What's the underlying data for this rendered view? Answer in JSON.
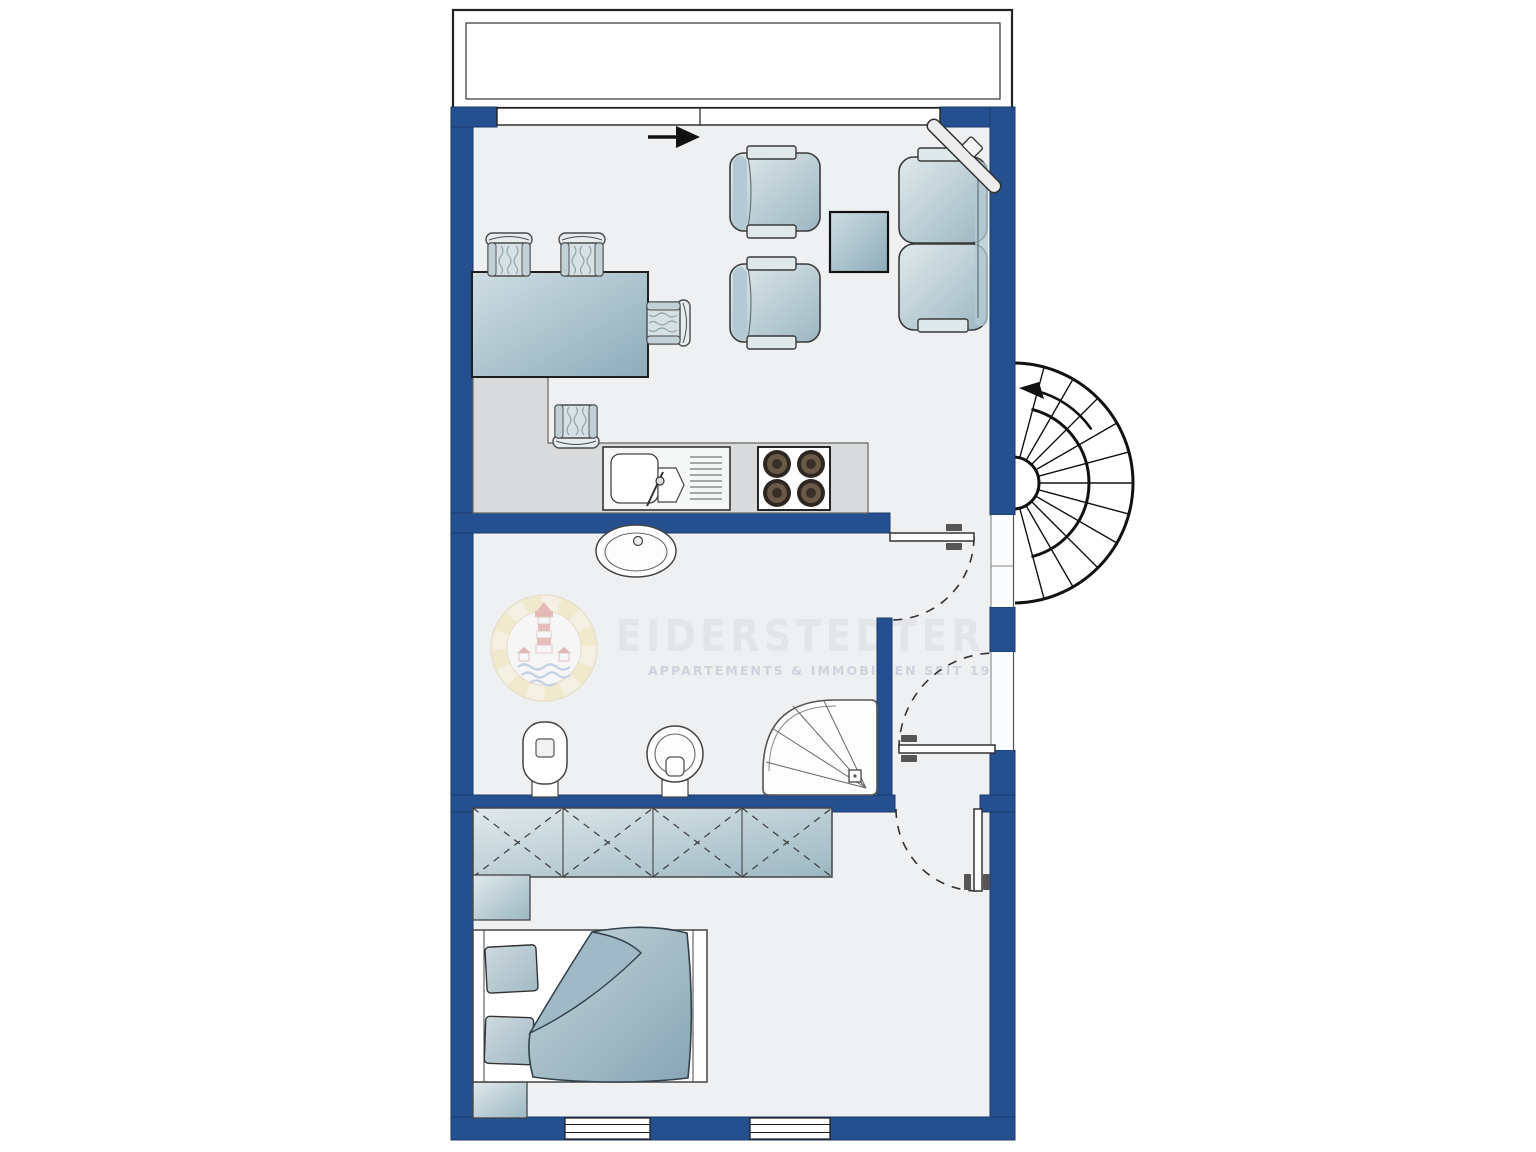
{
  "document": {
    "type": "apartment-floor-plan",
    "description": "Top-down architectural floor plan of a one-bedroom apartment with balcony and external spiral staircase"
  },
  "watermark": {
    "brand": "EIDERSTEDTER",
    "tagline": "APPARTEMENTS & IMMOBILIEN SEIT 1978",
    "logo": "lighthouse-lifebuoy-logo"
  },
  "colors": {
    "wall": "#24508f",
    "floor": "#eef0f2",
    "outline": "#1f1f1f",
    "furniture_fill": "#b9cdd6",
    "counter": "#d8dadc",
    "hob_burner": "#5b4a3a",
    "watermark_brand": "#e3e5e9",
    "watermark_tagline": "#ccd3dc"
  },
  "rooms": [
    {
      "name": "balcony",
      "position": "top"
    },
    {
      "name": "living-room-with-open-kitchen",
      "position": "upper"
    },
    {
      "name": "bathroom",
      "position": "middle-left"
    },
    {
      "name": "hallway",
      "position": "middle-right"
    },
    {
      "name": "bedroom",
      "position": "bottom"
    }
  ],
  "fixtures_and_furniture": {
    "living_room": [
      "dining-table",
      "dining-chair",
      "dining-chair",
      "dining-chair",
      "dining-chair",
      "armchair",
      "armchair",
      "coffee-table",
      "sofa",
      "corner-tv",
      "entrance-direction-arrow"
    ],
    "kitchen": [
      "l-shaped-counter",
      "double-sink-with-drainer",
      "four-burner-hob"
    ],
    "bathroom": [
      "washbasin",
      "bidet",
      "toilet",
      "corner-shower"
    ],
    "bedroom": [
      "wardrobe-four-sections",
      "nightstand",
      "double-bed-with-two-pillows-and-duvet",
      "nightstand"
    ]
  },
  "doors": [
    {
      "name": "bathroom-door",
      "swing": "into hallway, hinge at wall corner"
    },
    {
      "name": "apartment-entry-door",
      "swing": "from spiral-stair landing into hallway"
    },
    {
      "name": "bedroom-door",
      "swing": "into bedroom, hinge right"
    }
  ],
  "stairs": {
    "type": "spiral-staircase",
    "location": "outside right wall",
    "direction": "up, counter-clockwise arrow"
  },
  "windows": {
    "top_wall": 1,
    "bottom_wall": 2
  }
}
